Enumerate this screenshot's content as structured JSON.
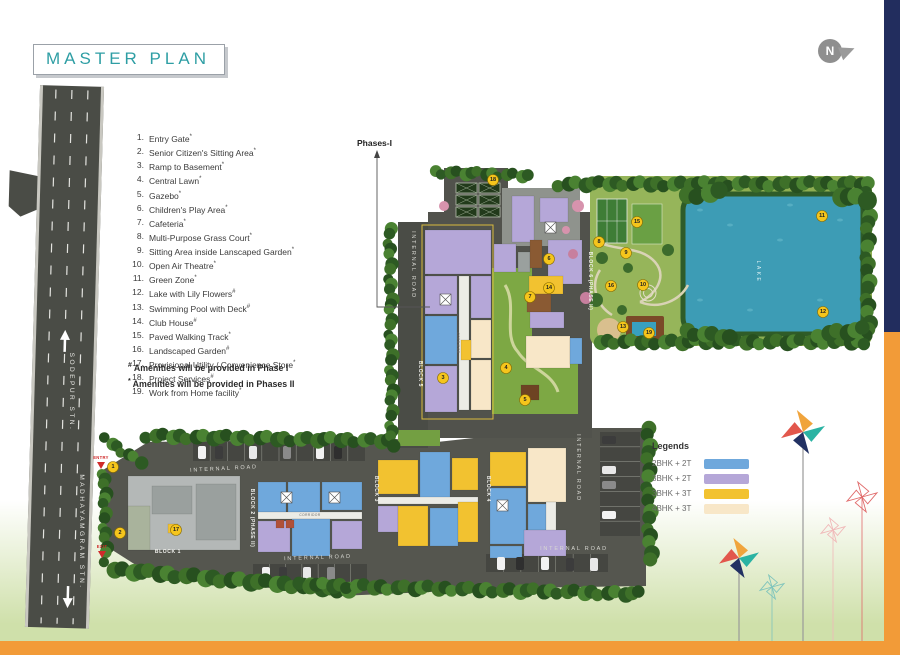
{
  "title": "MASTER PLAN",
  "compass": {
    "letter": "N"
  },
  "phase_label": "Phases-I",
  "amenities": {
    "items": [
      {
        "num": "1.",
        "label": "Entry Gate",
        "sup": "*"
      },
      {
        "num": "2.",
        "label": "Senior Citizen's Sitting Area",
        "sup": "*"
      },
      {
        "num": "3.",
        "label": "Ramp to Basement",
        "sup": "*"
      },
      {
        "num": "4.",
        "label": "Central Lawn",
        "sup": "*"
      },
      {
        "num": "5.",
        "label": "Gazebo",
        "sup": "*"
      },
      {
        "num": "6.",
        "label": "Children's Play Area",
        "sup": "*"
      },
      {
        "num": "7.",
        "label": "Cafeteria",
        "sup": "*"
      },
      {
        "num": "8.",
        "label": "Multi-Purpose Grass Court",
        "sup": "*"
      },
      {
        "num": "9.",
        "label": "Sitting Area inside Lanscaped Garden",
        "sup": "*"
      },
      {
        "num": "10.",
        "label": "Open Air Theatre",
        "sup": "*"
      },
      {
        "num": "11.",
        "label": "Green Zone",
        "sup": "*"
      },
      {
        "num": "12.",
        "label": "Lake with Lily Flowers",
        "sup": "#"
      },
      {
        "num": "13.",
        "label": "Swimming Pool with Deck",
        "sup": "#"
      },
      {
        "num": "14.",
        "label": "Club House",
        "sup": "#"
      },
      {
        "num": "15.",
        "label": "Paved Walking Track",
        "sup": "*"
      },
      {
        "num": "16.",
        "label": "Landscaped Garden",
        "sup": "#"
      },
      {
        "num": "17.",
        "label": "Provisional Utility / Convenience Store",
        "sup": "*"
      },
      {
        "num": "18.",
        "label": "Project Services",
        "sup": "#"
      },
      {
        "num": "19.",
        "label": "Work from Home facility",
        "sup": "*"
      }
    ],
    "footnotes": [
      {
        "sym": "#",
        "text": "Amenities will be provided in Phase I"
      },
      {
        "sym": "*",
        "text": "Amenities will be provided in Phases II"
      }
    ]
  },
  "legend": {
    "title": "Legends",
    "items": [
      {
        "label": "2BHK + 2T",
        "color": "#6FA8DC"
      },
      {
        "label": "3BHK + 2T",
        "color": "#B5A7D8"
      },
      {
        "label": "3BHK + 3T",
        "color": "#F2C230"
      },
      {
        "label": "4BHK + 3T",
        "color": "#F8E7C8"
      }
    ]
  },
  "plan": {
    "labels": [
      {
        "t": "SODEPUR STN.",
        "x": 70,
        "y": 392,
        "r": 90,
        "c": "roadmain"
      },
      {
        "t": "MADHAYAMGRAM STN.",
        "x": 80,
        "y": 532,
        "r": 90,
        "c": "roadmain"
      },
      {
        "t": "ENTRY",
        "x": 101,
        "y": 459,
        "r": 0,
        "c": "entry"
      },
      {
        "t": "EXIT",
        "x": 102,
        "y": 548,
        "r": 0,
        "c": "entry"
      },
      {
        "t": "INTERNAL ROAD",
        "x": 224,
        "y": 470,
        "r": -3,
        "c": "road"
      },
      {
        "t": "INTERNAL ROAD",
        "x": 318,
        "y": 559,
        "r": -2,
        "c": "road"
      },
      {
        "t": "INTERNAL ROAD",
        "x": 574,
        "y": 550,
        "r": 0,
        "c": "road"
      },
      {
        "t": "INTERNAL ROAD",
        "x": 412,
        "y": 265,
        "r": 90,
        "c": "road"
      },
      {
        "t": "INTERNAL ROAD",
        "x": 577,
        "y": 468,
        "r": 90,
        "c": "road"
      },
      {
        "t": "BLOCK 1",
        "x": 168,
        "y": 553,
        "r": 0,
        "c": "block"
      },
      {
        "t": "BLOCK 2 (PHASE II)",
        "x": 251,
        "y": 518,
        "r": 90,
        "c": "block"
      },
      {
        "t": "BLOCK 3",
        "x": 375,
        "y": 489,
        "r": 90,
        "c": "block"
      },
      {
        "t": "BLOCK 4",
        "x": 487,
        "y": 489,
        "r": 90,
        "c": "block"
      },
      {
        "t": "BLOCK 5",
        "x": 419,
        "y": 374,
        "r": 90,
        "c": "block"
      },
      {
        "t": "BLOCK 6 (PHASE II)",
        "x": 589,
        "y": 281,
        "r": 90,
        "c": "block"
      },
      {
        "t": "LAKE",
        "x": 757,
        "y": 272,
        "r": 90,
        "c": "lake"
      },
      {
        "t": "CORRIDOR",
        "x": 310,
        "y": 516,
        "r": 0,
        "c": "corridor"
      },
      {
        "t": "CORRIDOR",
        "x": 457,
        "y": 343,
        "r": 90,
        "c": "corridor"
      }
    ],
    "markers": [
      {
        "n": "1",
        "x": 113,
        "y": 467
      },
      {
        "n": "2",
        "x": 120,
        "y": 533
      },
      {
        "n": "3",
        "x": 443,
        "y": 378
      },
      {
        "n": "4",
        "x": 506,
        "y": 368
      },
      {
        "n": "5",
        "x": 525,
        "y": 400
      },
      {
        "n": "6",
        "x": 549,
        "y": 259
      },
      {
        "n": "7",
        "x": 530,
        "y": 297
      },
      {
        "n": "8",
        "x": 599,
        "y": 242
      },
      {
        "n": "9",
        "x": 626,
        "y": 253
      },
      {
        "n": "10",
        "x": 643,
        "y": 285
      },
      {
        "n": "11",
        "x": 822,
        "y": 216
      },
      {
        "n": "12",
        "x": 823,
        "y": 312
      },
      {
        "n": "13",
        "x": 623,
        "y": 327
      },
      {
        "n": "14",
        "x": 549,
        "y": 288
      },
      {
        "n": "15",
        "x": 637,
        "y": 222
      },
      {
        "n": "16",
        "x": 611,
        "y": 286
      },
      {
        "n": "17",
        "x": 176,
        "y": 530
      },
      {
        "n": "18",
        "x": 493,
        "y": 180
      },
      {
        "n": "19",
        "x": 649,
        "y": 333
      }
    ],
    "units": [
      [
        128,
        476,
        112,
        74,
        "g"
      ],
      [
        152,
        486,
        40,
        28,
        "g2"
      ],
      [
        196,
        484,
        40,
        56,
        "g2"
      ],
      [
        128,
        506,
        22,
        44,
        "g3"
      ],
      [
        168,
        524,
        10,
        9,
        "y"
      ],
      [
        258,
        482,
        28,
        30,
        "b"
      ],
      [
        288,
        482,
        32,
        30,
        "b"
      ],
      [
        322,
        482,
        40,
        28,
        "b"
      ],
      [
        258,
        512,
        104,
        7,
        "w"
      ],
      [
        258,
        521,
        32,
        31,
        "p"
      ],
      [
        292,
        519,
        38,
        37,
        "b"
      ],
      [
        332,
        521,
        30,
        28,
        "p"
      ],
      [
        276,
        520,
        8,
        8,
        "r"
      ],
      [
        286,
        520,
        8,
        8,
        "r"
      ],
      [
        378,
        460,
        40,
        34,
        "y"
      ],
      [
        420,
        452,
        30,
        48,
        "b"
      ],
      [
        452,
        458,
        26,
        32,
        "y"
      ],
      [
        378,
        497,
        100,
        7,
        "w"
      ],
      [
        378,
        506,
        20,
        26,
        "p"
      ],
      [
        398,
        506,
        30,
        40,
        "y"
      ],
      [
        430,
        508,
        28,
        38,
        "b"
      ],
      [
        458,
        502,
        20,
        40,
        "y"
      ],
      [
        490,
        452,
        36,
        34,
        "y"
      ],
      [
        528,
        448,
        38,
        54,
        "c"
      ],
      [
        490,
        488,
        36,
        56,
        "b"
      ],
      [
        528,
        504,
        18,
        26,
        "b"
      ],
      [
        546,
        502,
        10,
        50,
        "w"
      ],
      [
        524,
        530,
        42,
        26,
        "p"
      ],
      [
        490,
        546,
        32,
        12,
        "b"
      ],
      [
        425,
        230,
        66,
        44,
        "p"
      ],
      [
        425,
        276,
        32,
        38,
        "p"
      ],
      [
        425,
        316,
        32,
        48,
        "b"
      ],
      [
        425,
        366,
        32,
        46,
        "p"
      ],
      [
        459,
        276,
        10,
        134,
        "w"
      ],
      [
        471,
        276,
        20,
        42,
        "p"
      ],
      [
        471,
        320,
        20,
        38,
        "c"
      ],
      [
        461,
        340,
        10,
        20,
        "y"
      ],
      [
        471,
        360,
        20,
        50,
        "c"
      ],
      [
        512,
        196,
        22,
        46,
        "p"
      ],
      [
        540,
        198,
        28,
        24,
        "p"
      ],
      [
        494,
        244,
        22,
        28,
        "p"
      ],
      [
        518,
        252,
        12,
        20,
        "g2"
      ],
      [
        530,
        240,
        12,
        28,
        "br"
      ],
      [
        548,
        240,
        34,
        44,
        "p"
      ],
      [
        529,
        276,
        34,
        18,
        "y"
      ],
      [
        527,
        294,
        24,
        18,
        "br"
      ],
      [
        530,
        312,
        34,
        16,
        "p"
      ],
      [
        526,
        336,
        44,
        32,
        "c"
      ],
      [
        570,
        338,
        12,
        26,
        "b"
      ],
      [
        521,
        385,
        18,
        15,
        "br2"
      ]
    ],
    "unit_colors": {
      "b": "#6FA8DC",
      "p": "#B5A7D8",
      "y": "#F2C230",
      "c": "#F8E7C8",
      "g": "#b4b8b7",
      "g2": "#9aa09e",
      "g3": "#a9b39c",
      "w": "#ecece6",
      "r": "#b05038",
      "br": "#8a5a33",
      "br2": "#6e4323"
    }
  },
  "colors": {
    "accent": "#2E9EA4",
    "frame_navy": "#222D5E",
    "frame_orange": "#F29B38",
    "lake": "#3D9CB5",
    "marker": "#F5C51C"
  }
}
